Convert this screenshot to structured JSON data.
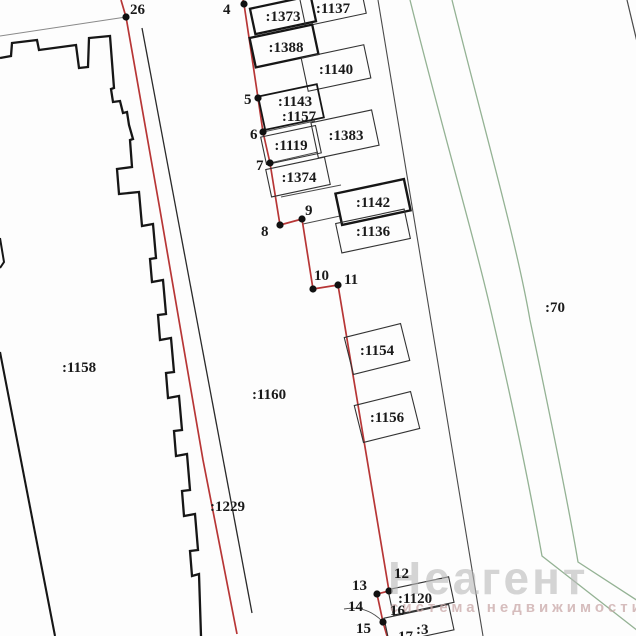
{
  "map_type": "cadastral-plan",
  "colors": {
    "boundary_red": "#b73636",
    "neighbor_green": "#94b294",
    "outline_black": "#161616",
    "thin_line": "#4a4a4a",
    "watermark_gray": "#b9b9b9"
  },
  "parcels": {
    "a1373": ":1373",
    "a1137": ":1137",
    "a1388": ":1388",
    "a1140": ":1140",
    "a1143": ":1143",
    "a1157": ":1157",
    "a1383": ":1383",
    "a1119": ":1119",
    "a1374": ":1374",
    "a1142": ":1142",
    "a1136": ":1136",
    "a1154": ":1154",
    "a1156": ":1156",
    "a1158": ":1158",
    "a1160": ":1160",
    "a1229": ":1229",
    "a70": ":70",
    "a1120": ":1120",
    "a3": ":3"
  },
  "points": {
    "n26": "26",
    "n4": "4",
    "n5": "5",
    "n6": "6",
    "n7": "7",
    "n8": "8",
    "n9": "9",
    "n10": "10",
    "n11": "11",
    "n12": "12",
    "n13": "13",
    "n14": "14",
    "n15": "15",
    "n16": "16",
    "n17": "17"
  },
  "watermark": {
    "title": "Неагент",
    "subtitle": "система недвижимости"
  }
}
